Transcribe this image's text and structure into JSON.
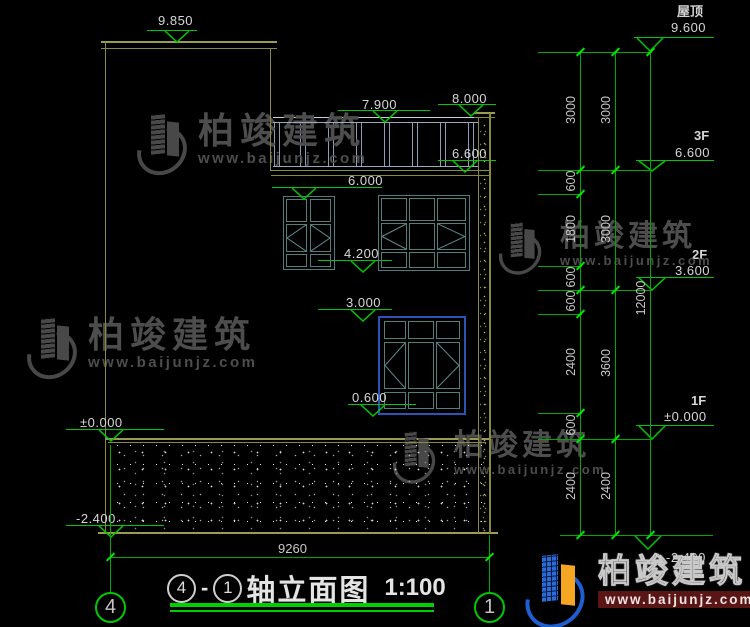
{
  "drawing": {
    "title": {
      "left_axis": "4",
      "dash": "-",
      "right_axis": "1",
      "name": "轴立面图",
      "scale": "1:100"
    },
    "grid": {
      "left_bubble": "4",
      "right_bubble": "1"
    },
    "levels": {
      "p9850": "9.850",
      "p8000": "8.000",
      "p7900": "7.900",
      "p6600": "6.600",
      "p6000": "6.000",
      "p4200": "4.200",
      "p3000": "3.000",
      "p0600": "0.600",
      "p0000": "±0.000",
      "pn2400": "-2.400"
    },
    "floors": {
      "roof_label": "屋顶",
      "roof_value": "9.600",
      "f3_label": "3F",
      "f3_value": "6.600",
      "f2_label": "2F",
      "f2_value": "3.600",
      "f1_label": "1F",
      "f1_value": "±0.000",
      "base_value": "-2.400"
    },
    "dims": {
      "chain_inner": [
        "3000",
        "600",
        "1800",
        "600",
        "600",
        "2400",
        "600",
        "2400"
      ],
      "chain_floor": [
        "3000",
        "3000",
        "3600",
        "2400"
      ],
      "total": "12000",
      "width": "9260"
    },
    "watermark": {
      "name": "柏竣建筑",
      "url": "www.baijunjz.com"
    },
    "colors": {
      "background": "#000000",
      "wall_olive": "#8a8a3e",
      "dimension_green": "#00c800",
      "text_gray": "#d6d6d6",
      "window_teal": "#4f7d7d",
      "window_blue": "#2a55b5",
      "railing_blue": "#9aa8bc",
      "logo_blue": "#1d5fd0",
      "logo_orange": "#f5a623",
      "watermark_gray": "#4d4d4d",
      "url_bar_red": "#5a1515"
    }
  }
}
